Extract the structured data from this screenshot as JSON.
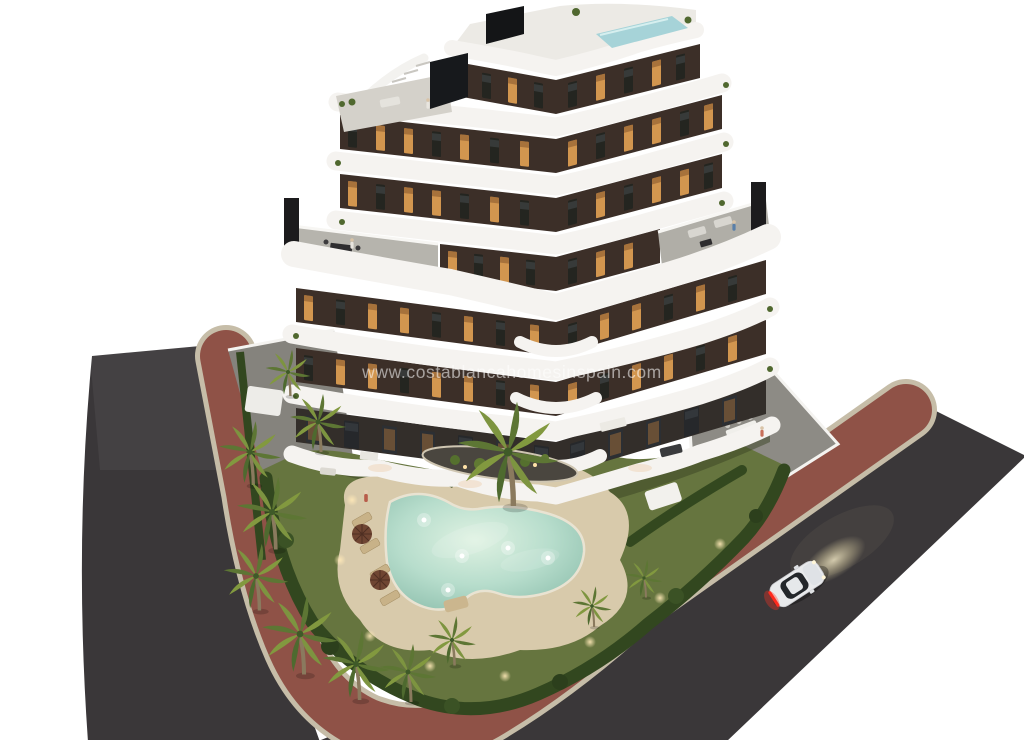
{
  "watermark": {
    "text": "www.costablancahomesinspain.com"
  },
  "colors": {
    "background": "#ffffff",
    "asphalt": "#3a3739",
    "sidewalk_red": "#8f5247",
    "curb_tan": "#c6bda8",
    "lawn": "#66753f",
    "hedge": "#32471f",
    "facade_brown": "#3c2f28",
    "balcony_white": "#f5f3f0",
    "window_lit": "#d2964f",
    "window_dark": "#242520",
    "pool_water": "#aed6c8",
    "pool_deck": "#d8caab",
    "roof_pool": "#a6d3d8",
    "car_body": "#e9eaec",
    "car_tail_light": "#ff2a1e",
    "headlight_glow": "#d8c9a0"
  },
  "scene": {
    "description": "Aerial dusk 3D render of a modern 7-storey apartment building with wavy white balconies, landscaped garden, free-form illuminated pool, palm trees, perimeter roads and a white car",
    "building_storeys": 7,
    "rooftop_pool": true,
    "roof_terraces": 2,
    "sun_loungers": 4,
    "parasols": 2,
    "car_headlights_on": true
  }
}
